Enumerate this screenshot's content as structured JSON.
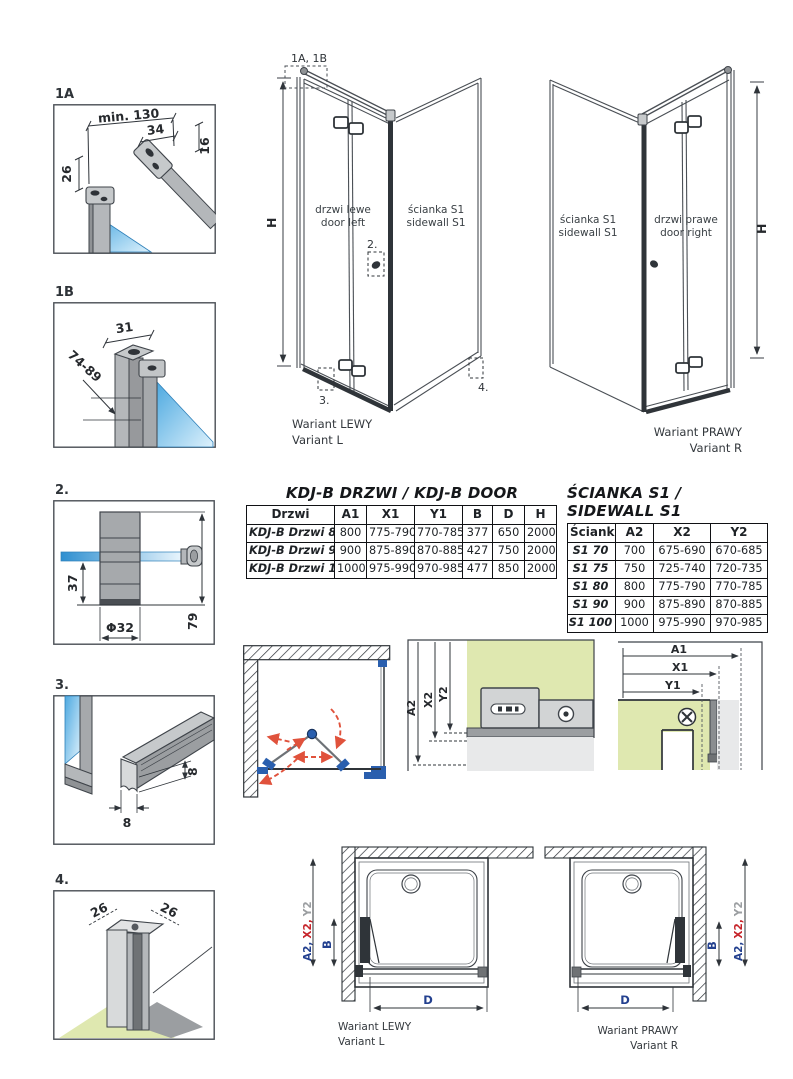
{
  "details": {
    "d1a": {
      "label": "1A",
      "dim_min130": "min. 130",
      "dim_34": "34",
      "dim_16": "16",
      "dim_26": "26"
    },
    "d1b": {
      "label": "1B",
      "dim_31": "31",
      "dim_74_89": "74-89"
    },
    "d2": {
      "label": "2.",
      "dim_37": "37",
      "dim_79": "79",
      "dim_phi": "Φ32"
    },
    "d3": {
      "label": "3.",
      "dim_8a": "8",
      "dim_8b": "8"
    },
    "d4": {
      "label": "4.",
      "dim_26a": "26",
      "dim_26b": "26"
    }
  },
  "iso_left": {
    "callout": "1A, 1B",
    "h": "H",
    "door_pl": "drzwi lewe",
    "door_en": "door left",
    "wall_pl": "ścianka S1",
    "wall_en": "sidewall S1",
    "m2": "2.",
    "m3": "3.",
    "m4": "4.",
    "caption_pl": "Wariant LEWY",
    "caption_en": "Variant L"
  },
  "iso_right": {
    "h": "H",
    "wall_pl": "ścianka S1",
    "wall_en": "sidewall S1",
    "door_pl": "drzwi prawe",
    "door_en": "door right",
    "caption_pl": "Wariant PRAWY",
    "caption_en": "Variant R"
  },
  "door_table": {
    "title": "KDJ-B  DRZWI / KDJ-B DOOR",
    "headers": [
      "Drzwi",
      "A1",
      "X1",
      "Y1",
      "B",
      "D",
      "H"
    ],
    "rows": [
      [
        "KDJ-B Drzwi 80",
        "800",
        "775-790",
        "770-785",
        "377",
        "650",
        "2000"
      ],
      [
        "KDJ-B Drzwi 90",
        "900",
        "875-890",
        "870-885",
        "427",
        "750",
        "2000"
      ],
      [
        "KDJ-B Drzwi 100",
        "1000",
        "975-990",
        "970-985",
        "477",
        "850",
        "2000"
      ]
    ]
  },
  "sidewall_table": {
    "title": "ŚCIANKA S1 / SIDEWALL S1",
    "headers": [
      "Ścianka",
      "A2",
      "X2",
      "Y2"
    ],
    "rows": [
      [
        "S1 70",
        "700",
        "675-690",
        "670-685"
      ],
      [
        "S1 75",
        "750",
        "725-740",
        "720-735"
      ],
      [
        "S1 80",
        "800",
        "775-790",
        "770-785"
      ],
      [
        "S1 90",
        "900",
        "875-890",
        "870-885"
      ],
      [
        "S1 100",
        "1000",
        "975-990",
        "970-985"
      ]
    ]
  },
  "section_side": {
    "a2": "A2",
    "x2": "X2",
    "y2": "Y2"
  },
  "section_door": {
    "a1": "A1",
    "x1": "X1",
    "y1": "Y1"
  },
  "plan_left": {
    "dim_parts": [
      "A2,",
      "X2,",
      "Y2"
    ],
    "b": "B",
    "d": "D",
    "caption_pl": "Wariant LEWY",
    "caption_en": "Variant L"
  },
  "plan_right": {
    "dim_parts": [
      "A2,",
      "X2,",
      "Y2"
    ],
    "b": "B",
    "d": "D",
    "caption_pl": "Wariant PRAWY",
    "caption_en": "Variant R"
  },
  "colors": {
    "accent_red": "#c6252b",
    "accent_blue": "#2456b4",
    "accent_purple": "#5f4fa3",
    "accent_gray": "#9b9ea1",
    "green_fill": "#dfe8b0",
    "glass_blue": "#5fb3e4",
    "line": "#3f444a",
    "arrow_red": "#e0523c"
  }
}
